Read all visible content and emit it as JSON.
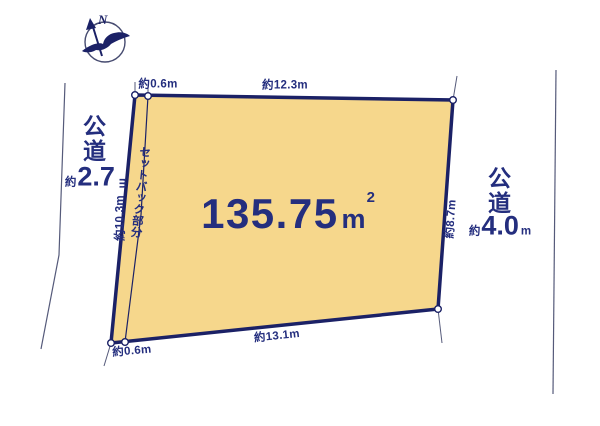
{
  "diagram": {
    "compass": {
      "north_label": "N"
    },
    "parcel": {
      "area": {
        "value": "135.75",
        "unit": "m",
        "exponent": "2"
      },
      "setback_label": "セットバック部分",
      "dimensions": {
        "top_setback": "約0.6m",
        "top": "約12.3m",
        "left": "約10.3m",
        "right": "約8.7m",
        "bottom": "約13.1m",
        "bottom_setback": "約0.6m"
      }
    },
    "roads": {
      "left": {
        "name": "公道",
        "width_prefix": "約",
        "width_value": "2.7",
        "width_unit": "m"
      },
      "right": {
        "name": "公道",
        "width_prefix": "約",
        "width_value": "4.0",
        "width_unit": "m"
      }
    },
    "colors": {
      "parcel_fill": "#F6D78C",
      "outline_navy": "#1B2166",
      "text_navy": "#242E7E",
      "road_line_gray": "#555A7A",
      "background": "#FFFFFF"
    }
  }
}
